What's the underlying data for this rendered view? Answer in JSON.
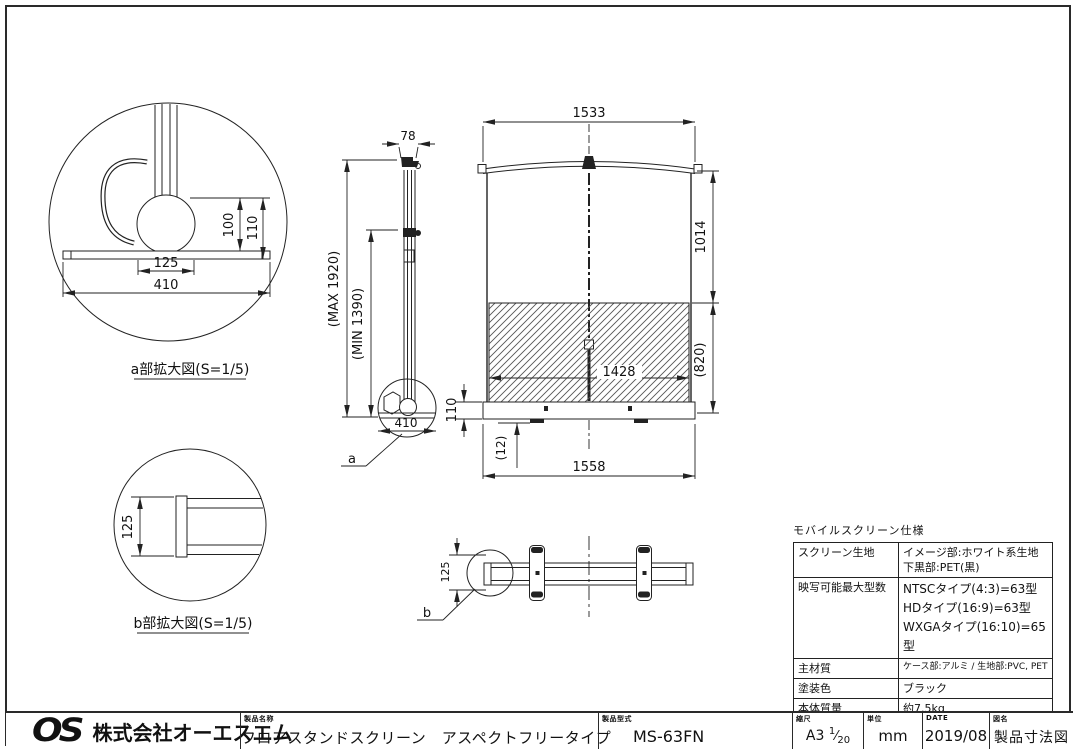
{
  "drawing": {
    "dims": {
      "detail_a_100": "100",
      "detail_a_110": "110",
      "detail_a_125": "125",
      "detail_a_410": "410",
      "side_78": "78",
      "side_max_height": "(MAX 1920)",
      "side_min_height": "(MIN 1390)",
      "side_410": "410",
      "base_110": "110",
      "base_12": "(12)",
      "front_1533": "1533",
      "front_1014": "1014",
      "front_1428": "1428",
      "front_820": "(820)",
      "front_1558": "1558",
      "plan_125": "125",
      "detail_b_125": "125"
    },
    "labels": {
      "detail_a": "a部拡大図(S=1/5)",
      "detail_b": "b部拡大図(S=1/5)",
      "ref_a": "a",
      "ref_b": "b"
    }
  },
  "spec_table": {
    "title": "モバイルスクリーン仕様",
    "rows": [
      {
        "label": "スクリーン生地",
        "lines": [
          "イメージ部:ホワイト系生地",
          "下黒部:PET(黒)"
        ]
      },
      {
        "label": "映写可能最大型数",
        "lines": [
          "NTSCタイプ(4:3)=63型",
          "HDタイプ(16:9)=63型",
          "WXGAタイプ(16:10)=65型"
        ]
      },
      {
        "label": "主材質",
        "lines": [
          "ケース部:アルミ / 生地部:PVC, PET"
        ]
      },
      {
        "label": "塗装色",
        "lines": [
          "ブラック"
        ]
      },
      {
        "label": "本体質量",
        "lines": [
          "約7.5kg"
        ]
      }
    ]
  },
  "title_block": {
    "logo": "OS",
    "company": "株式会社オーエスエム",
    "product_name_label": "製品名称",
    "product_name": "フロアスタンドスクリーン　アスペクトフリータイプ",
    "model_label": "製品型式",
    "model": "MS-63FN",
    "scale_label": "縮尺",
    "scale_sheet": "A3",
    "scale_numerator": "1",
    "scale_denominator": "20",
    "unit_label": "単位",
    "unit": "mm",
    "date_label": "DATE",
    "date": "2019/08",
    "drawing_title_label": "図名",
    "drawing_title": "製品寸法図"
  }
}
